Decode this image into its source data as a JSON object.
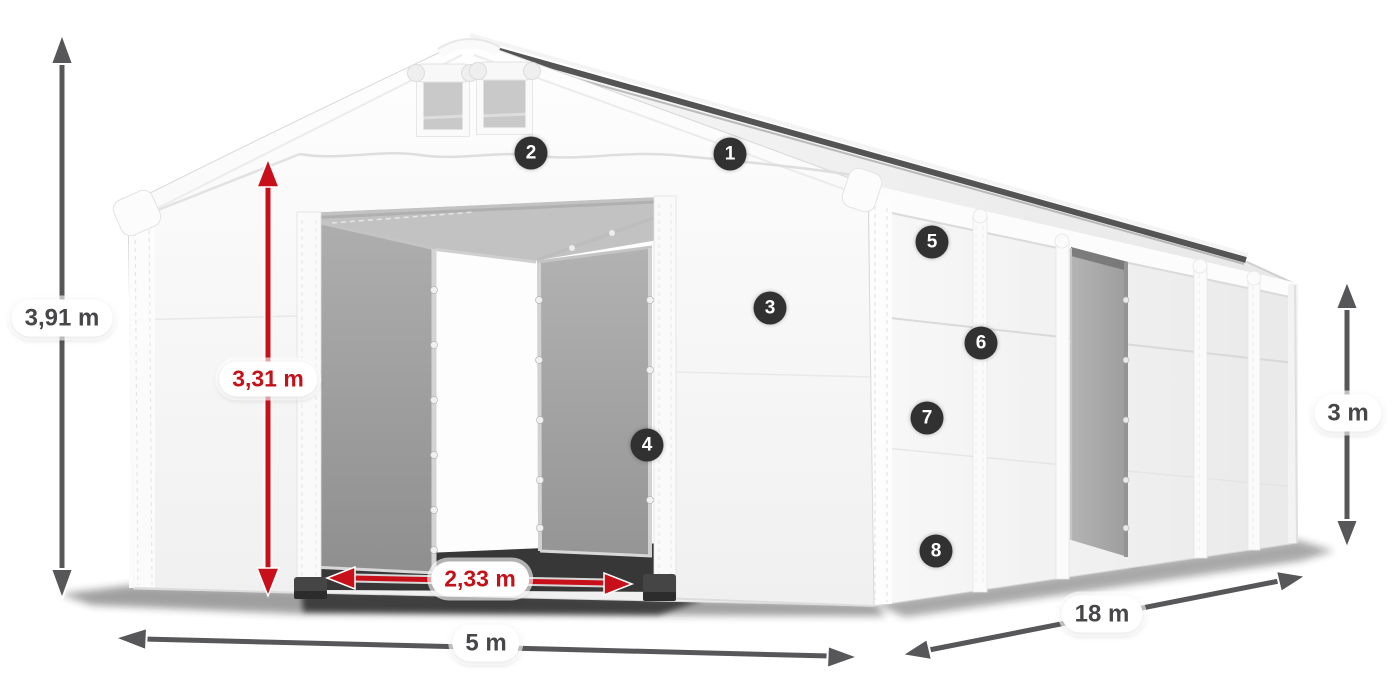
{
  "dimensions": {
    "total_height": {
      "value": "3,91 m",
      "color": "#47474a"
    },
    "inner_height": {
      "value": "3,31 m",
      "color": "#c3121a"
    },
    "door_width": {
      "value": "2,33 m",
      "color": "#c3121a"
    },
    "front_width": {
      "value": "5 m",
      "color": "#47474a"
    },
    "length": {
      "value": "18 m",
      "color": "#47474a"
    },
    "side_height": {
      "value": "3 m",
      "color": "#47474a"
    }
  },
  "markers": [
    {
      "label": "1"
    },
    {
      "label": "2"
    },
    {
      "label": "3"
    },
    {
      "label": "4"
    },
    {
      "label": "5"
    },
    {
      "label": "6"
    },
    {
      "label": "7"
    },
    {
      "label": "8"
    }
  ],
  "colors": {
    "arrow_gray": "#57575a",
    "arrow_red": "#c8101a",
    "pill_bg": "#ffffff",
    "pill_text_gray": "#47474a",
    "pill_text_red": "#c3121a",
    "marker_bg": "#313131",
    "marker_text": "#ffffff",
    "tarp_white": "#f5f5f5",
    "tarp_gray": "#9b9b9b"
  }
}
